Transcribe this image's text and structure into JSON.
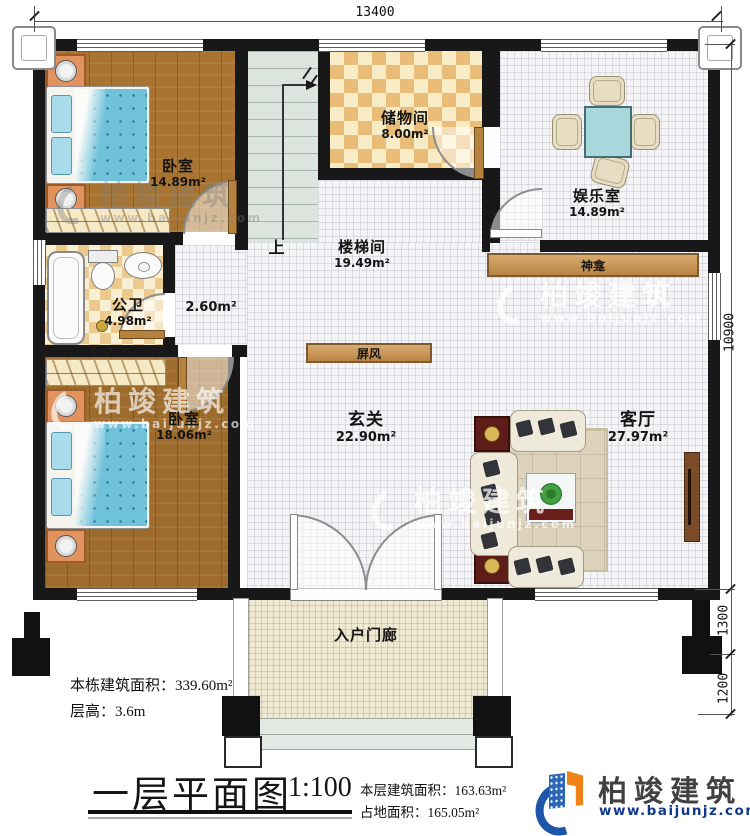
{
  "plan": {
    "rooms": {
      "bedroom1": {
        "name": "卧室",
        "area": "14.89m²"
      },
      "storage": {
        "name": "储物间",
        "area": "8.00m²"
      },
      "entertainment": {
        "name": "娱乐室",
        "area": "14.89m²"
      },
      "stair_hall": {
        "name": "楼梯间",
        "area": "19.49m²"
      },
      "bathroom": {
        "name": "公卫",
        "area": "4.98m²"
      },
      "corridor": {
        "area": "2.60m²"
      },
      "bedroom2": {
        "name": "卧室",
        "area": "18.06m²"
      },
      "foyer": {
        "name": "玄关",
        "area": "22.90m²"
      },
      "living": {
        "name": "客厅",
        "area": "27.97m²"
      },
      "porch": {
        "name": "入户门廊"
      }
    },
    "fixtures": {
      "shrine": "神龛",
      "screen": "屏风",
      "stairs_up": "上"
    },
    "dimensions": {
      "top": "13400",
      "right_main": "10900",
      "right_porch": "1300",
      "right_steps": "1200"
    }
  },
  "notes": {
    "building_area": "本栋建筑面积：339.60m²",
    "floor_height": "层高：3.6m"
  },
  "titleblock": {
    "title": "一层平面图",
    "scale": "1:100",
    "floor_area": "本层建筑面积：163.63m²",
    "footprint_area": "占地面积：165.05m²"
  },
  "brand": {
    "name": "柏竣建筑",
    "url": "www.baijunjz.com"
  },
  "watermark": {
    "name": "柏竣建筑",
    "url": "www.baijunjz.com"
  },
  "colors": {
    "wall": "#181818",
    "wood_floor": "#a9742f",
    "tile_floor": "#f4f4f6",
    "checker_tan": "#e9bc77",
    "checker_cream": "#f8ecc6",
    "porch_floor": "#f0e9d1",
    "stair": "#dde4de",
    "furniture_wood": "#c09055",
    "bed_blue": "#6fc2da",
    "brand_blue": "#1d55a8",
    "brand_orange": "#ef8318",
    "url_navy": "#11398b"
  }
}
